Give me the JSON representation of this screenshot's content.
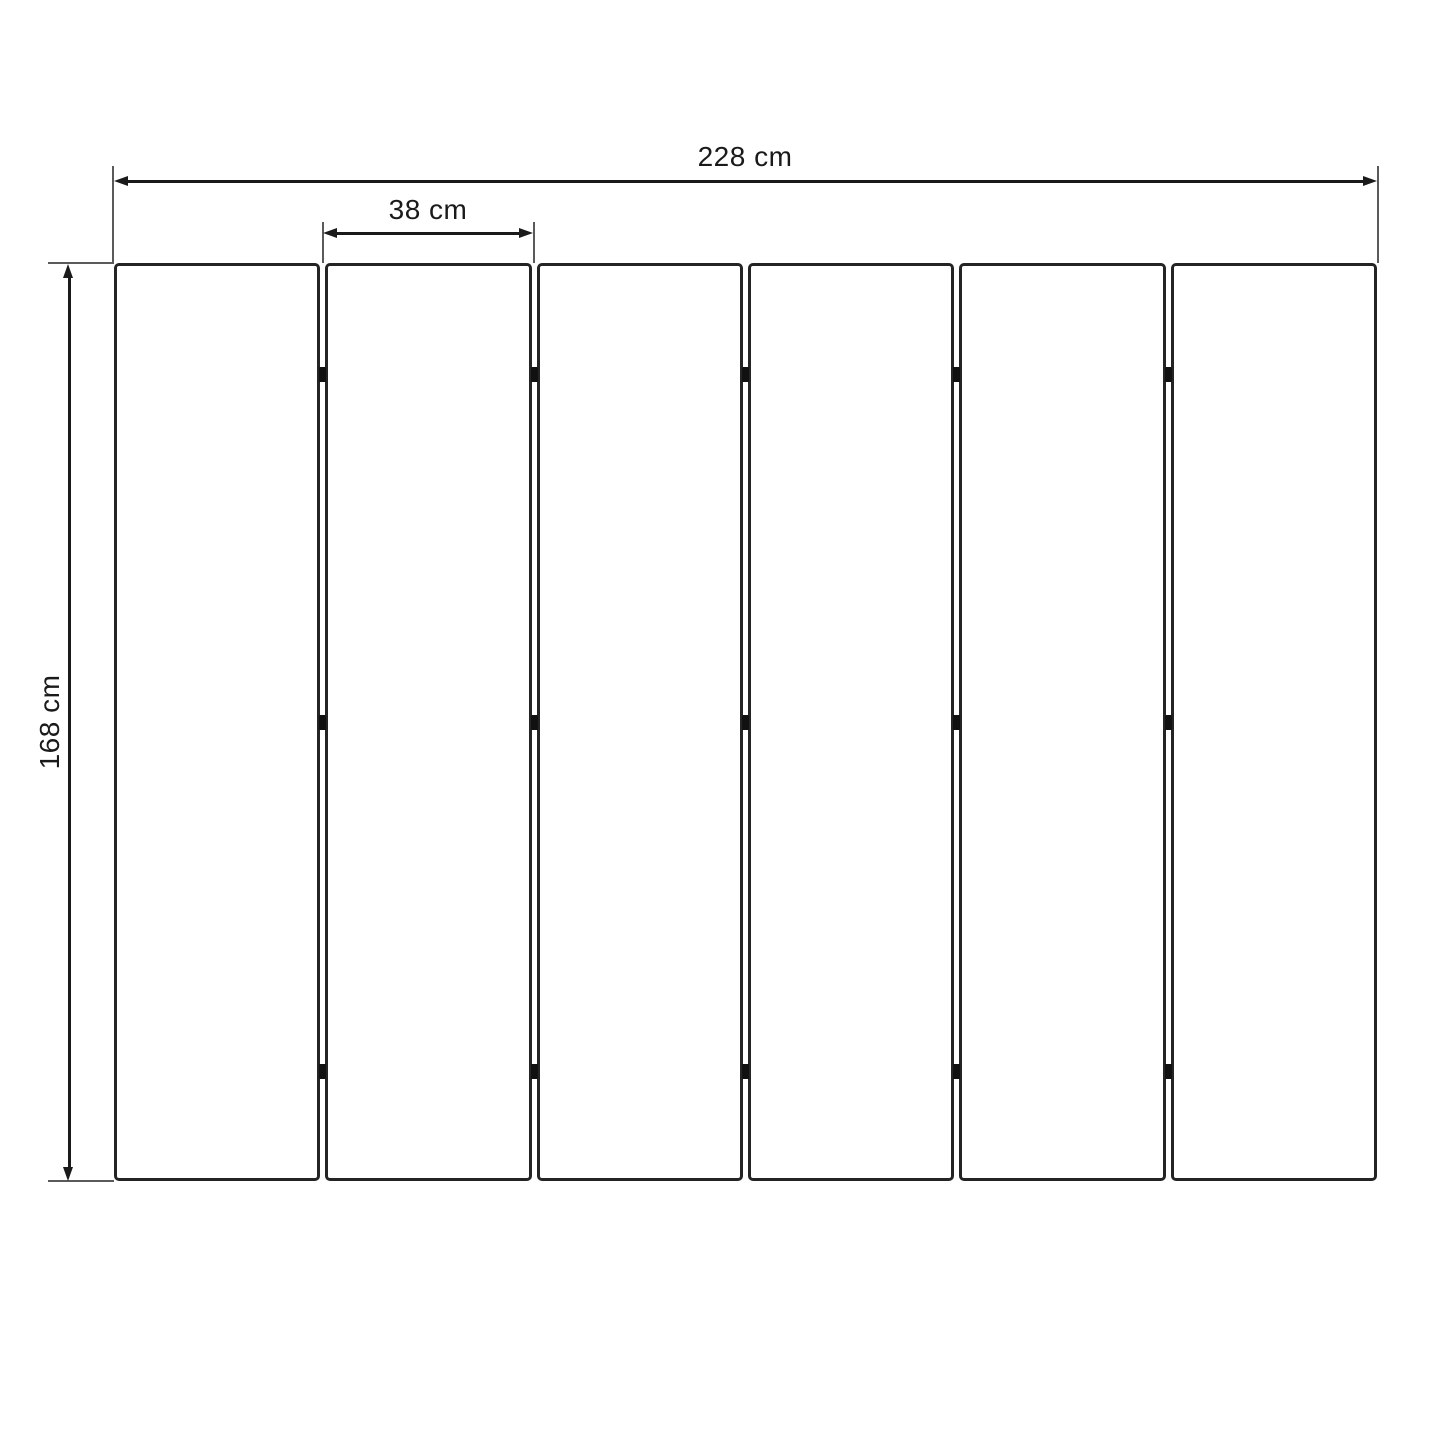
{
  "diagram": {
    "type": "dimension-drawing",
    "subject": "six-panel folding screen front view",
    "dimensions": {
      "total_width": {
        "label": "228 cm",
        "value_cm": 228
      },
      "panel_width": {
        "label": "38 cm",
        "value_cm": 38
      },
      "height": {
        "label": "168 cm",
        "value_cm": 168
      }
    },
    "panels": {
      "count": 6,
      "joint_count": 5,
      "hinges_per_joint": 3,
      "hinge_y_centers_px": [
        374,
        722,
        1071
      ]
    },
    "colors": {
      "line": "#1a1a1a",
      "extension_line": "#5a5a5a",
      "panel_border": "#242424",
      "hinge": "#111111",
      "background": "#ffffff"
    }
  }
}
